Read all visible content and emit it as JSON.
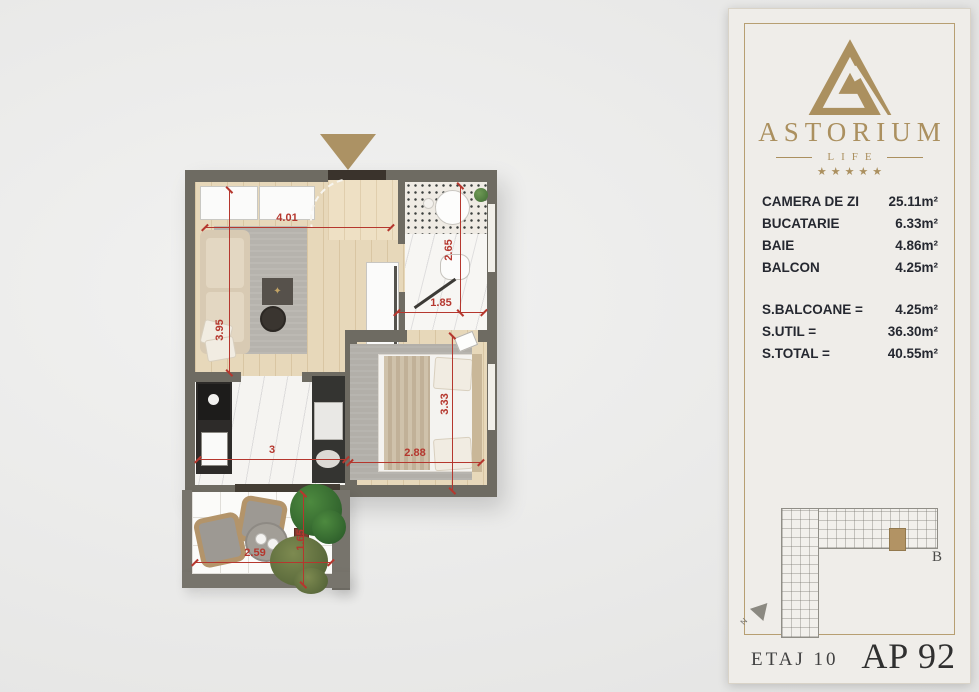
{
  "panel": {
    "brand": {
      "name": "ASTORIUM",
      "subtitle": "LIFE",
      "stars": "★★★★★",
      "gold": "#ab905f"
    },
    "rooms": [
      {
        "label": "CAMERA DE ZI",
        "value": "25.11m²"
      },
      {
        "label": "BUCATARIE",
        "value": "6.33m²"
      },
      {
        "label": "BAIE",
        "value": "4.86m²"
      },
      {
        "label": "BALCON",
        "value": "4.25m²"
      }
    ],
    "totals": [
      {
        "label": "S.BALCOANE =",
        "value": "4.25m²"
      },
      {
        "label": "S.UTIL =",
        "value": "36.30m²"
      },
      {
        "label": "S.TOTAL =",
        "value": "40.55m²"
      }
    ],
    "building": {
      "block_label": "B",
      "north_label": "N"
    },
    "footer": {
      "floor_label": "ETAJ 10",
      "apartment_label": "AP 92"
    }
  },
  "floorplan": {
    "accent_red": "#b5372e",
    "wall_color": "#6e6b62",
    "entry_marker_color": "#ac9264",
    "dims": {
      "living_width": "4.01",
      "living_height": "3.95",
      "bath_width": "1.85",
      "bath_height": "2.65",
      "kitchen_width": "3",
      "sleeping_width": "2.88",
      "sleeping_height": "3.33",
      "balcony_width": "2.59",
      "balcony_height": "1.65"
    }
  }
}
